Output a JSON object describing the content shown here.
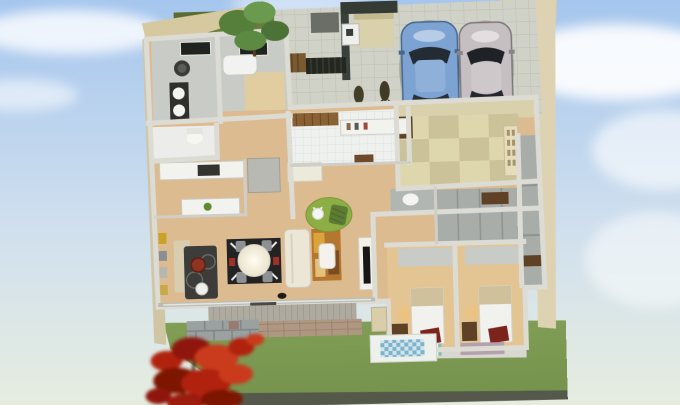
{
  "scene": {
    "description": "3D isometric cutaway render of a single-story Japanese house floor plan, viewed from above, surrounded by lawn, hedge, a red maple tree and a tiled driveway with two parked cars",
    "style": "3d-floorplan-render",
    "visible_text": {
      "hanging_scroll": "illegible Japanese calligraphy on tatami-room wall scroll"
    },
    "rooms": [
      {
        "name": "washroom",
        "floor": "gray",
        "contents": [
          "washing-machine",
          "double-basin-vanity"
        ]
      },
      {
        "name": "bathroom",
        "floor": "gray-beige",
        "contents": [
          "bathtub",
          "window"
        ]
      },
      {
        "name": "toilet-1",
        "floor": "white",
        "contents": [
          "toilet"
        ]
      },
      {
        "name": "kitchen",
        "floor": "wood",
        "contents": [
          "white-counters",
          "cooktop",
          "refrigerator"
        ]
      },
      {
        "name": "living-dining",
        "floor": "wood",
        "contents": [
          "round-dining-table",
          "four-chairs",
          "black-rug",
          "sofa",
          "armchair",
          "abstract-orange-rug",
          "floor-lamp",
          "wall-tv",
          "stove-rug-with-kettle",
          "framed-pictures"
        ]
      },
      {
        "name": "entrance-hall-genkan",
        "floor": "white-tile",
        "contents": [
          "wooden-front-door",
          "shoe-cabinet",
          "step",
          "doormat"
        ]
      },
      {
        "name": "tatami-room",
        "floor": "checkered-tatami",
        "contents": [
          "hanging-scroll",
          "low-cabinet"
        ]
      },
      {
        "name": "hallway",
        "floor": "wood",
        "contents": [
          "green-round-rug",
          "beanbag",
          "white-cat"
        ]
      },
      {
        "name": "toilet-2",
        "floor": "gray",
        "contents": [
          "toilet"
        ]
      },
      {
        "name": "closet-row",
        "floor": "gray",
        "contents": [
          "wooden-shelf-boxes"
        ]
      },
      {
        "name": "bedroom-1",
        "floor": "wood",
        "contents": [
          "bed",
          "red-floor-cushion",
          "desk",
          "teal-checked-rug",
          "lamp-glow"
        ]
      },
      {
        "name": "bedroom-2",
        "floor": "wood",
        "contents": [
          "bed",
          "red-floor-cushion",
          "desk",
          "mauve-rug",
          "lamp-glow"
        ]
      }
    ],
    "vehicles": [
      {
        "name": "blue-sedan",
        "color": "#7da3d3"
      },
      {
        "name": "silver-sedan",
        "color": "#c6bfc1"
      }
    ],
    "landscape": [
      "sky-with-clouds",
      "lawn",
      "hedge",
      "green-tree",
      "red-japanese-maple",
      "three-potted-shrubs",
      "tiled-approach",
      "dark-entrance-gate",
      "wooden-fence",
      "dark-porch-structure-with-sink",
      "wood-deck",
      "brick-terrace-steps",
      "stone-garden-wall",
      "blue-tiled-small-terrace",
      "black-cat"
    ],
    "palette": {
      "sky_top": "#a5c6ee",
      "sky_mid": "#cfdfee",
      "sky_bottom": "#e6ede0",
      "cloud": "#ffffff",
      "lawn": "#7d9a52",
      "lawn_dark": "#66844a",
      "hedge": "#6b7d3c",
      "wood_floor": "#ddbb90",
      "wood_floor_light": "#e8cfa6",
      "driveway_tile": "#d0d1c7",
      "exterior_wall": "#ddd3b2",
      "interior_wall": "#dcdcd5",
      "tatami_light": "#ded6ad",
      "tatami_dark": "#ccc29a",
      "car_blue": "#7da3d3",
      "car_silver": "#c6bfc1",
      "maple_red": "#b0220f",
      "rug_green": "#8cae45",
      "rug_teal": "#88bcae",
      "rug_mauve": "#b5a0ad",
      "rug_black": "#232323",
      "cushion_red": "#7c241c",
      "sofa_cream": "#ece6d6",
      "tv_black": "#161616"
    }
  }
}
